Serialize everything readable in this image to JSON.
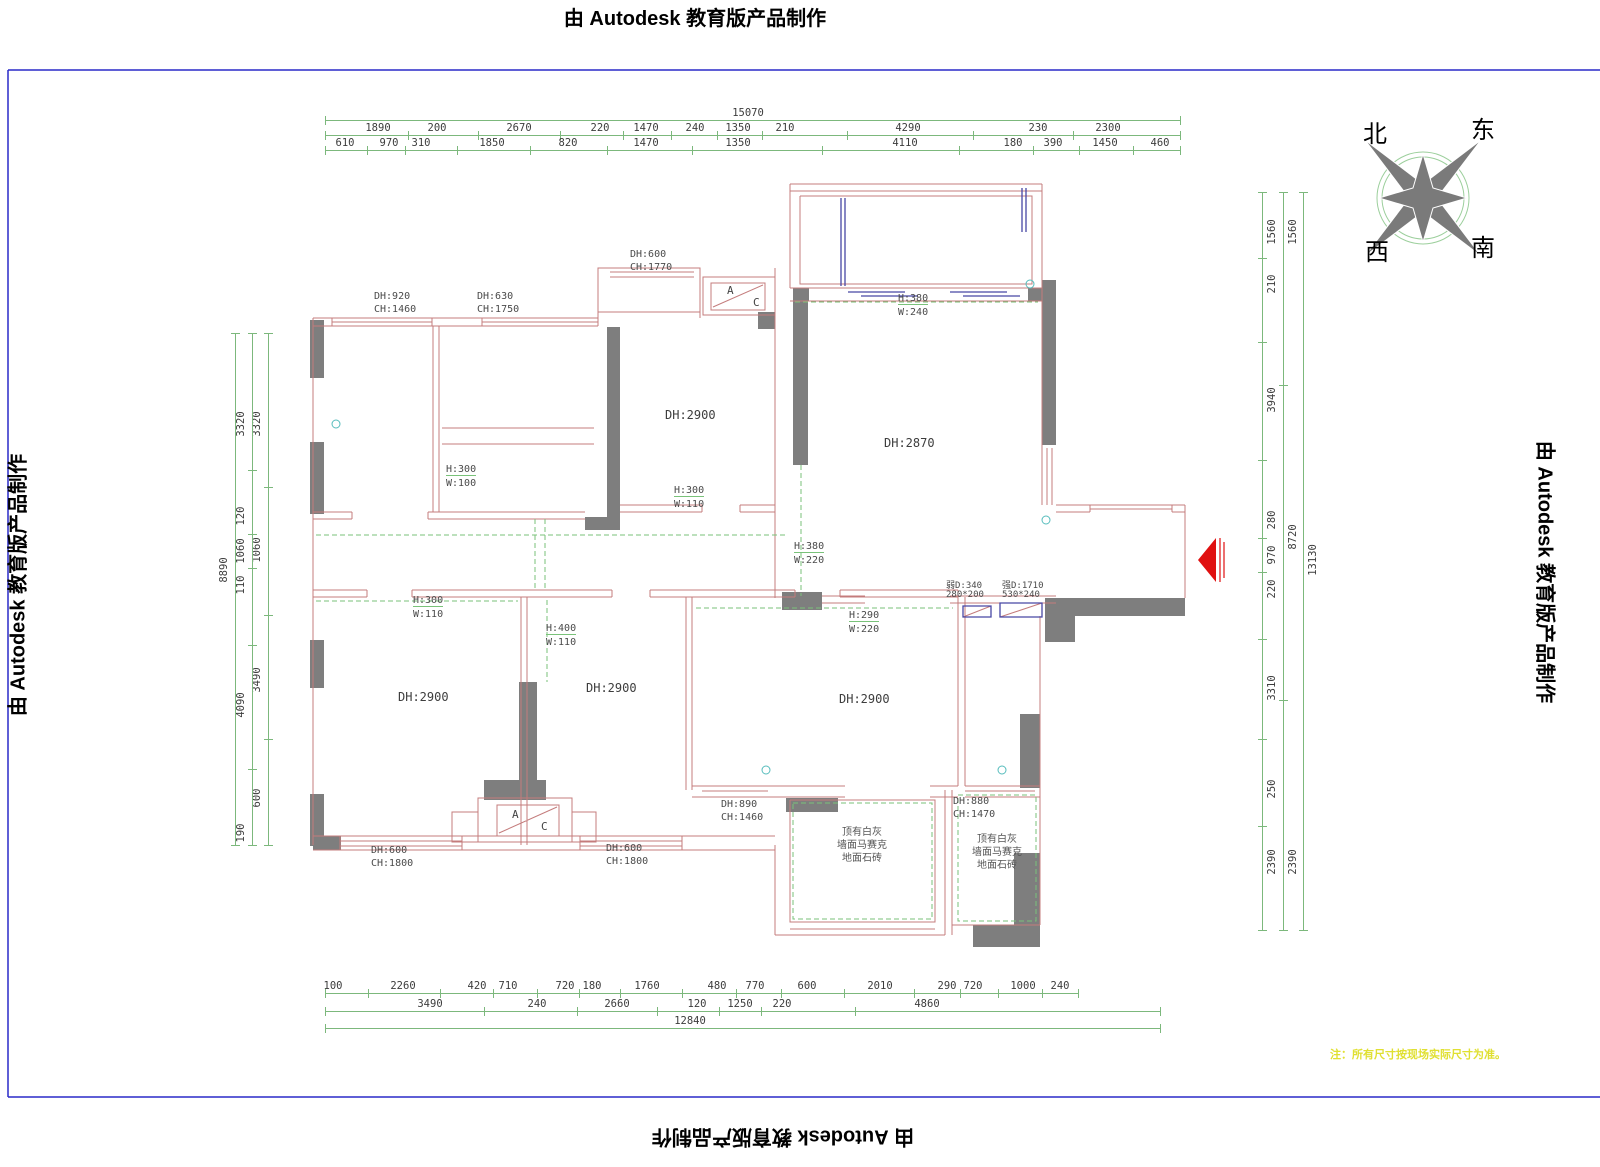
{
  "watermarks": {
    "top": "由 Autodesk 教育版产品制作",
    "bottom": "由 Autodesk 教育版产品制作",
    "left": "由 Autodesk 教育版产品制作",
    "right": "由 Autodesk 教育版产品制作"
  },
  "compass": {
    "north": "北",
    "east": "东",
    "west": "西",
    "south": "南"
  },
  "note": "注：所有尺寸按现场实际尺寸为准。",
  "colors": {
    "wall_line": "#c47c7c",
    "wall_fill": "#7e7e7e",
    "dim_green": "#7cb87c",
    "dash_green": "#79c279",
    "blue": "#4747a5",
    "frame_blue": "#2a2ac8",
    "arrow_red": "#e01010",
    "note_yellow": "#e0e032",
    "teal": "#55bcbc"
  },
  "dim_rows": [
    {
      "name": "top-total",
      "axis": "h",
      "line": 120,
      "from": 325,
      "to": 1180,
      "ty": 107,
      "labels": [
        {
          "t": "15070",
          "c": 748
        }
      ]
    },
    {
      "name": "top-row1",
      "axis": "h",
      "line": 135,
      "from": 325,
      "to": 1180,
      "ty": 122,
      "labels": [
        {
          "t": "1890",
          "c": 378
        },
        {
          "t": "200",
          "c": 437
        },
        {
          "t": "2670",
          "c": 519
        },
        {
          "t": "220",
          "c": 600
        },
        {
          "t": "1470",
          "c": 646
        },
        {
          "t": "240",
          "c": 695
        },
        {
          "t": "1350",
          "c": 738
        },
        {
          "t": "210",
          "c": 785
        },
        {
          "t": "4290",
          "c": 908
        },
        {
          "t": "230",
          "c": 1038
        },
        {
          "t": "2300",
          "c": 1108
        }
      ]
    },
    {
      "name": "top-row2",
      "axis": "h",
      "line": 150,
      "from": 325,
      "to": 1180,
      "ty": 137,
      "labels": [
        {
          "t": "610",
          "c": 345
        },
        {
          "t": "970",
          "c": 389
        },
        {
          "t": "310",
          "c": 421
        },
        {
          "t": "1850",
          "c": 492
        },
        {
          "t": "820",
          "c": 568
        },
        {
          "t": "1470",
          "c": 646
        },
        {
          "t": "1350",
          "c": 738
        },
        {
          "t": "4110",
          "c": 905
        },
        {
          "t": "180",
          "c": 1013
        },
        {
          "t": "390",
          "c": 1053
        },
        {
          "t": "1450",
          "c": 1105
        },
        {
          "t": "460",
          "c": 1160
        }
      ]
    },
    {
      "name": "bottom-row1",
      "axis": "h",
      "line": 993,
      "from": 325,
      "to": 1078,
      "ty": 980,
      "labels": [
        {
          "t": "100",
          "c": 333
        },
        {
          "t": "2260",
          "c": 403
        },
        {
          "t": "420",
          "c": 477
        },
        {
          "t": "710",
          "c": 508
        },
        {
          "t": "720",
          "c": 565
        },
        {
          "t": "180",
          "c": 592
        },
        {
          "t": "1760",
          "c": 647
        },
        {
          "t": "480",
          "c": 717
        },
        {
          "t": "770",
          "c": 755
        },
        {
          "t": "600",
          "c": 807
        },
        {
          "t": "2010",
          "c": 880
        },
        {
          "t": "290",
          "c": 947
        },
        {
          "t": "720",
          "c": 973
        },
        {
          "t": "1000",
          "c": 1023
        },
        {
          "t": "240",
          "c": 1060
        }
      ]
    },
    {
      "name": "bottom-row2",
      "axis": "h",
      "line": 1011,
      "from": 325,
      "to": 1160,
      "ty": 998,
      "labels": [
        {
          "t": "3490",
          "c": 430
        },
        {
          "t": "240",
          "c": 537
        },
        {
          "t": "2660",
          "c": 617
        },
        {
          "t": "120",
          "c": 697
        },
        {
          "t": "1250",
          "c": 740
        },
        {
          "t": "220",
          "c": 782
        },
        {
          "t": "4860",
          "c": 927
        }
      ]
    },
    {
      "name": "bottom-total",
      "axis": "h",
      "line": 1028,
      "from": 325,
      "to": 1160,
      "ty": 1015,
      "labels": [
        {
          "t": "12840",
          "c": 690
        }
      ]
    },
    {
      "name": "left-col-inner",
      "axis": "v",
      "line": 268,
      "tx": 257,
      "from": 333,
      "to": 845,
      "labels": [
        {
          "t": "3320",
          "c": 424
        },
        {
          "t": "1060",
          "c": 550
        },
        {
          "t": "3490",
          "c": 680
        },
        {
          "t": "600",
          "c": 798
        }
      ]
    },
    {
      "name": "left-col-mid",
      "axis": "v",
      "line": 252,
      "tx": 241,
      "from": 333,
      "to": 845,
      "labels": [
        {
          "t": "3320",
          "c": 424
        },
        {
          "t": "120",
          "c": 516
        },
        {
          "t": "1060",
          "c": 551
        },
        {
          "t": "110",
          "c": 585
        },
        {
          "t": "4090",
          "c": 705
        },
        {
          "t": "190",
          "c": 833
        }
      ]
    },
    {
      "name": "left-col-total",
      "axis": "v",
      "line": 235,
      "tx": 224,
      "from": 333,
      "to": 845,
      "labels": [
        {
          "t": "8890",
          "c": 570
        }
      ]
    },
    {
      "name": "right-col-inner",
      "axis": "v",
      "line": 1262,
      "tx": 1272,
      "from": 192,
      "to": 930,
      "labels": [
        {
          "t": "1560",
          "c": 232
        },
        {
          "t": "210",
          "c": 284
        },
        {
          "t": "3940",
          "c": 400
        },
        {
          "t": "280",
          "c": 520
        },
        {
          "t": "970",
          "c": 555
        },
        {
          "t": "220",
          "c": 589
        },
        {
          "t": "3310",
          "c": 688
        },
        {
          "t": "250",
          "c": 789
        },
        {
          "t": "2390",
          "c": 862
        }
      ]
    },
    {
      "name": "right-col-mid",
      "axis": "v",
      "line": 1283,
      "tx": 1293,
      "from": 192,
      "to": 930,
      "labels": [
        {
          "t": "1560",
          "c": 232
        },
        {
          "t": "8720",
          "c": 537
        },
        {
          "t": "2390",
          "c": 862
        }
      ]
    },
    {
      "name": "right-col-total",
      "axis": "v",
      "line": 1303,
      "tx": 1313,
      "from": 192,
      "to": 930,
      "labels": [
        {
          "t": "13130",
          "c": 560
        }
      ]
    }
  ],
  "plan_labels": [
    {
      "t": "DH:920",
      "x": 374,
      "y": 291,
      "c": "lab"
    },
    {
      "t": "CH:1460",
      "x": 374,
      "y": 304,
      "c": "lab"
    },
    {
      "t": "DH:630",
      "x": 477,
      "y": 291,
      "c": "lab"
    },
    {
      "t": "CH:1750",
      "x": 477,
      "y": 304,
      "c": "lab"
    },
    {
      "t": "DH:600",
      "x": 630,
      "y": 249,
      "c": "lab"
    },
    {
      "t": "CH:1770",
      "x": 630,
      "y": 262,
      "c": "lab"
    },
    {
      "t": "H:380",
      "x": 898,
      "y": 293,
      "c": "op"
    },
    {
      "t": "W:240",
      "x": 898,
      "y": 307,
      "c": "lab"
    },
    {
      "t": "DH:2900",
      "x": 665,
      "y": 408,
      "c": "room"
    },
    {
      "t": "DH:2870",
      "x": 884,
      "y": 436,
      "c": "room"
    },
    {
      "t": "H:300",
      "x": 446,
      "y": 464,
      "c": "op"
    },
    {
      "t": "W:100",
      "x": 446,
      "y": 478,
      "c": "lab"
    },
    {
      "t": "H:300",
      "x": 674,
      "y": 485,
      "c": "op"
    },
    {
      "t": "W:110",
      "x": 674,
      "y": 499,
      "c": "lab"
    },
    {
      "t": "H:380",
      "x": 794,
      "y": 541,
      "c": "op"
    },
    {
      "t": "W:220",
      "x": 794,
      "y": 555,
      "c": "lab"
    },
    {
      "t": "弱D:340",
      "x": 946,
      "y": 578,
      "c": "lab2"
    },
    {
      "t": "280*200",
      "x": 946,
      "y": 590,
      "c": "lab2"
    },
    {
      "t": "强D:1710",
      "x": 1002,
      "y": 578,
      "c": "lab2"
    },
    {
      "t": "530*240",
      "x": 1002,
      "y": 590,
      "c": "lab2"
    },
    {
      "t": "H:290",
      "x": 849,
      "y": 610,
      "c": "op"
    },
    {
      "t": "W:220",
      "x": 849,
      "y": 624,
      "c": "lab"
    },
    {
      "t": "H:300",
      "x": 413,
      "y": 595,
      "c": "op"
    },
    {
      "t": "W:110",
      "x": 413,
      "y": 609,
      "c": "lab"
    },
    {
      "t": "H:400",
      "x": 546,
      "y": 623,
      "c": "op"
    },
    {
      "t": "W:110",
      "x": 546,
      "y": 637,
      "c": "lab"
    },
    {
      "t": "DH:2900",
      "x": 398,
      "y": 690,
      "c": "room"
    },
    {
      "t": "DH:2900",
      "x": 586,
      "y": 681,
      "c": "room"
    },
    {
      "t": "DH:2900",
      "x": 839,
      "y": 692,
      "c": "room"
    },
    {
      "t": "DH:890",
      "x": 721,
      "y": 799,
      "c": "lab"
    },
    {
      "t": "CH:1460",
      "x": 721,
      "y": 812,
      "c": "lab"
    },
    {
      "t": "DH:880",
      "x": 953,
      "y": 796,
      "c": "lab"
    },
    {
      "t": "CH:1470",
      "x": 953,
      "y": 809,
      "c": "lab"
    },
    {
      "t": "DH:600",
      "x": 371,
      "y": 845,
      "c": "lab"
    },
    {
      "t": "CH:1800",
      "x": 371,
      "y": 858,
      "c": "lab"
    },
    {
      "t": "DH:600",
      "x": 606,
      "y": 843,
      "c": "lab"
    },
    {
      "t": "CH:1800",
      "x": 606,
      "y": 856,
      "c": "lab"
    },
    {
      "t": "顶有白灰",
      "x": 862,
      "y": 823,
      "c": "cjk"
    },
    {
      "t": "墙面马赛克",
      "x": 862,
      "y": 836,
      "c": "cjk"
    },
    {
      "t": "地面石砖",
      "x": 862,
      "y": 849,
      "c": "cjk"
    },
    {
      "t": "顶有白灰",
      "x": 997,
      "y": 830,
      "c": "cjk"
    },
    {
      "t": "墙面马赛克",
      "x": 997,
      "y": 843,
      "c": "cjk"
    },
    {
      "t": "地面石砖",
      "x": 997,
      "y": 856,
      "c": "cjk"
    },
    {
      "t": "A",
      "x": 727,
      "y": 284,
      "c": "ac"
    },
    {
      "t": "C",
      "x": 753,
      "y": 296,
      "c": "ac"
    },
    {
      "t": "A",
      "x": 512,
      "y": 808,
      "c": "ac"
    },
    {
      "t": "C",
      "x": 541,
      "y": 820,
      "c": "ac"
    }
  ]
}
